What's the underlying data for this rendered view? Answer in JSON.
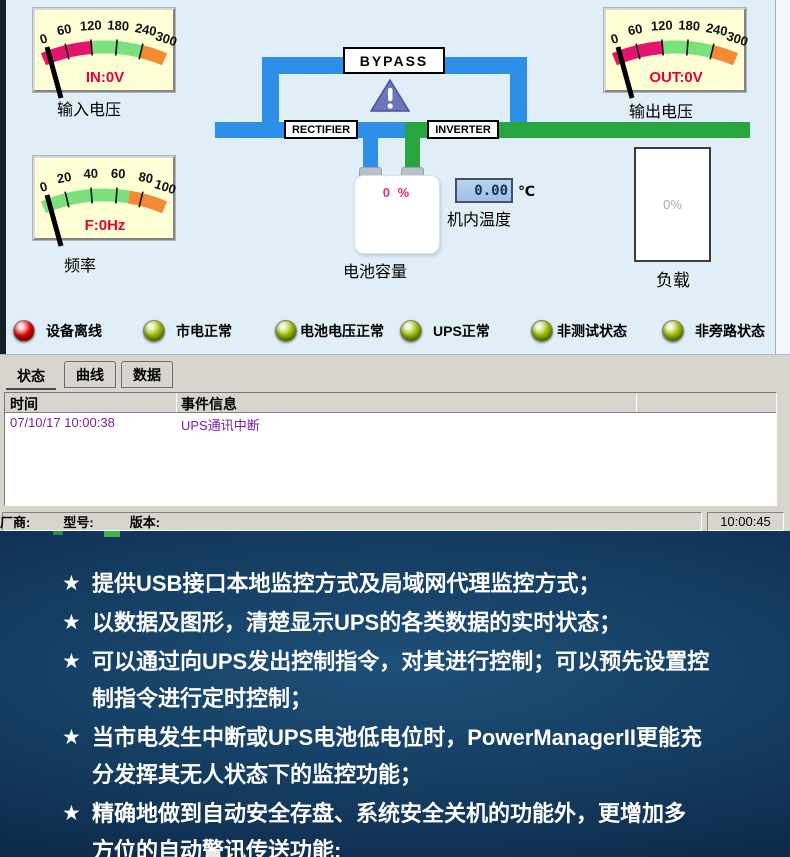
{
  "app": {
    "gauges": {
      "input": {
        "ticks": [
          "0",
          "60",
          "120",
          "180",
          "240",
          "300"
        ],
        "value_label": "IN:0V",
        "caption": "输入电压"
      },
      "output": {
        "ticks": [
          "0",
          "60",
          "120",
          "180",
          "240",
          "300"
        ],
        "value_label": "OUT:0V",
        "caption": "输出电压"
      },
      "frequency": {
        "ticks": [
          "0",
          "20",
          "40",
          "60",
          "80",
          "100"
        ],
        "value_label": "F:0Hz",
        "caption": "频率"
      }
    },
    "diagram": {
      "bypass_label": "BYPASS",
      "rectifier_label": "RECTIFIER",
      "inverter_label": "INVERTER",
      "battery": {
        "value": "0 %",
        "caption": "电池容量"
      },
      "temperature": {
        "value": "0.00",
        "unit": "℃",
        "caption": "机内温度"
      },
      "load": {
        "value": "0%",
        "caption": "负载"
      }
    },
    "status_leds": [
      {
        "label": "设备离线",
        "state": "red"
      },
      {
        "label": "市电正常",
        "state": "green"
      },
      {
        "label": "电池电压正常",
        "state": "green"
      },
      {
        "label": "UPS正常",
        "state": "green"
      },
      {
        "label": "非测试状态",
        "state": "green"
      },
      {
        "label": "非旁路状态",
        "state": "green"
      }
    ],
    "tabs": [
      {
        "label": "状态",
        "active": true
      },
      {
        "label": "曲线",
        "active": false
      },
      {
        "label": "数据",
        "active": false
      }
    ],
    "event_table": {
      "columns": [
        "时间",
        "事件信息"
      ],
      "rows": [
        {
          "time": "07/10/17 10:00:38",
          "event": "UPS通讯中断"
        }
      ]
    },
    "status_bar": {
      "manufacturer_label": "厂商:",
      "model_label": "型号:",
      "version_label": "版本:",
      "clock": "10:00:45"
    }
  },
  "features": {
    "bullet": "★",
    "items": [
      {
        "lines": [
          "提供USB接口本地监控方式及局域网代理监控方式；"
        ]
      },
      {
        "lines": [
          "以数据及图形，清楚显示UPS的各类数据的实时状态；"
        ]
      },
      {
        "lines": [
          "可以通过向UPS发出控制指令，对其进行控制；可以预先设置控",
          "制指令进行定时控制；"
        ]
      },
      {
        "lines": [
          "当市电发生中断或UPS电池低电位时，PowerManagerII更能充",
          "分发挥其无人状态下的监控功能；"
        ]
      },
      {
        "lines": [
          "精确地做到自动安全存盘、系统安全关机的功能外，更增加多",
          "方位的自动警讯传送功能;"
        ]
      }
    ]
  },
  "colors": {
    "app_bg": "#e0eef8",
    "gauge_bg": "#ffffd6",
    "arc_magenta": "#e6146e",
    "arc_green": "#7ce07c",
    "arc_orange": "#f58a34",
    "gauge_value_red": "#e60039",
    "pipe_blue": "#2d8fe8",
    "pipe_green": "#27a53f",
    "warning_triangle": "#6b76bb",
    "led_red": "#e00000",
    "led_green": "#9ab800",
    "event_text_purple": "#7b1fa2",
    "panel_gray": "#d8d5ce",
    "dark_section_bg": "#0e2c4d",
    "feature_text": "#ffffff"
  }
}
